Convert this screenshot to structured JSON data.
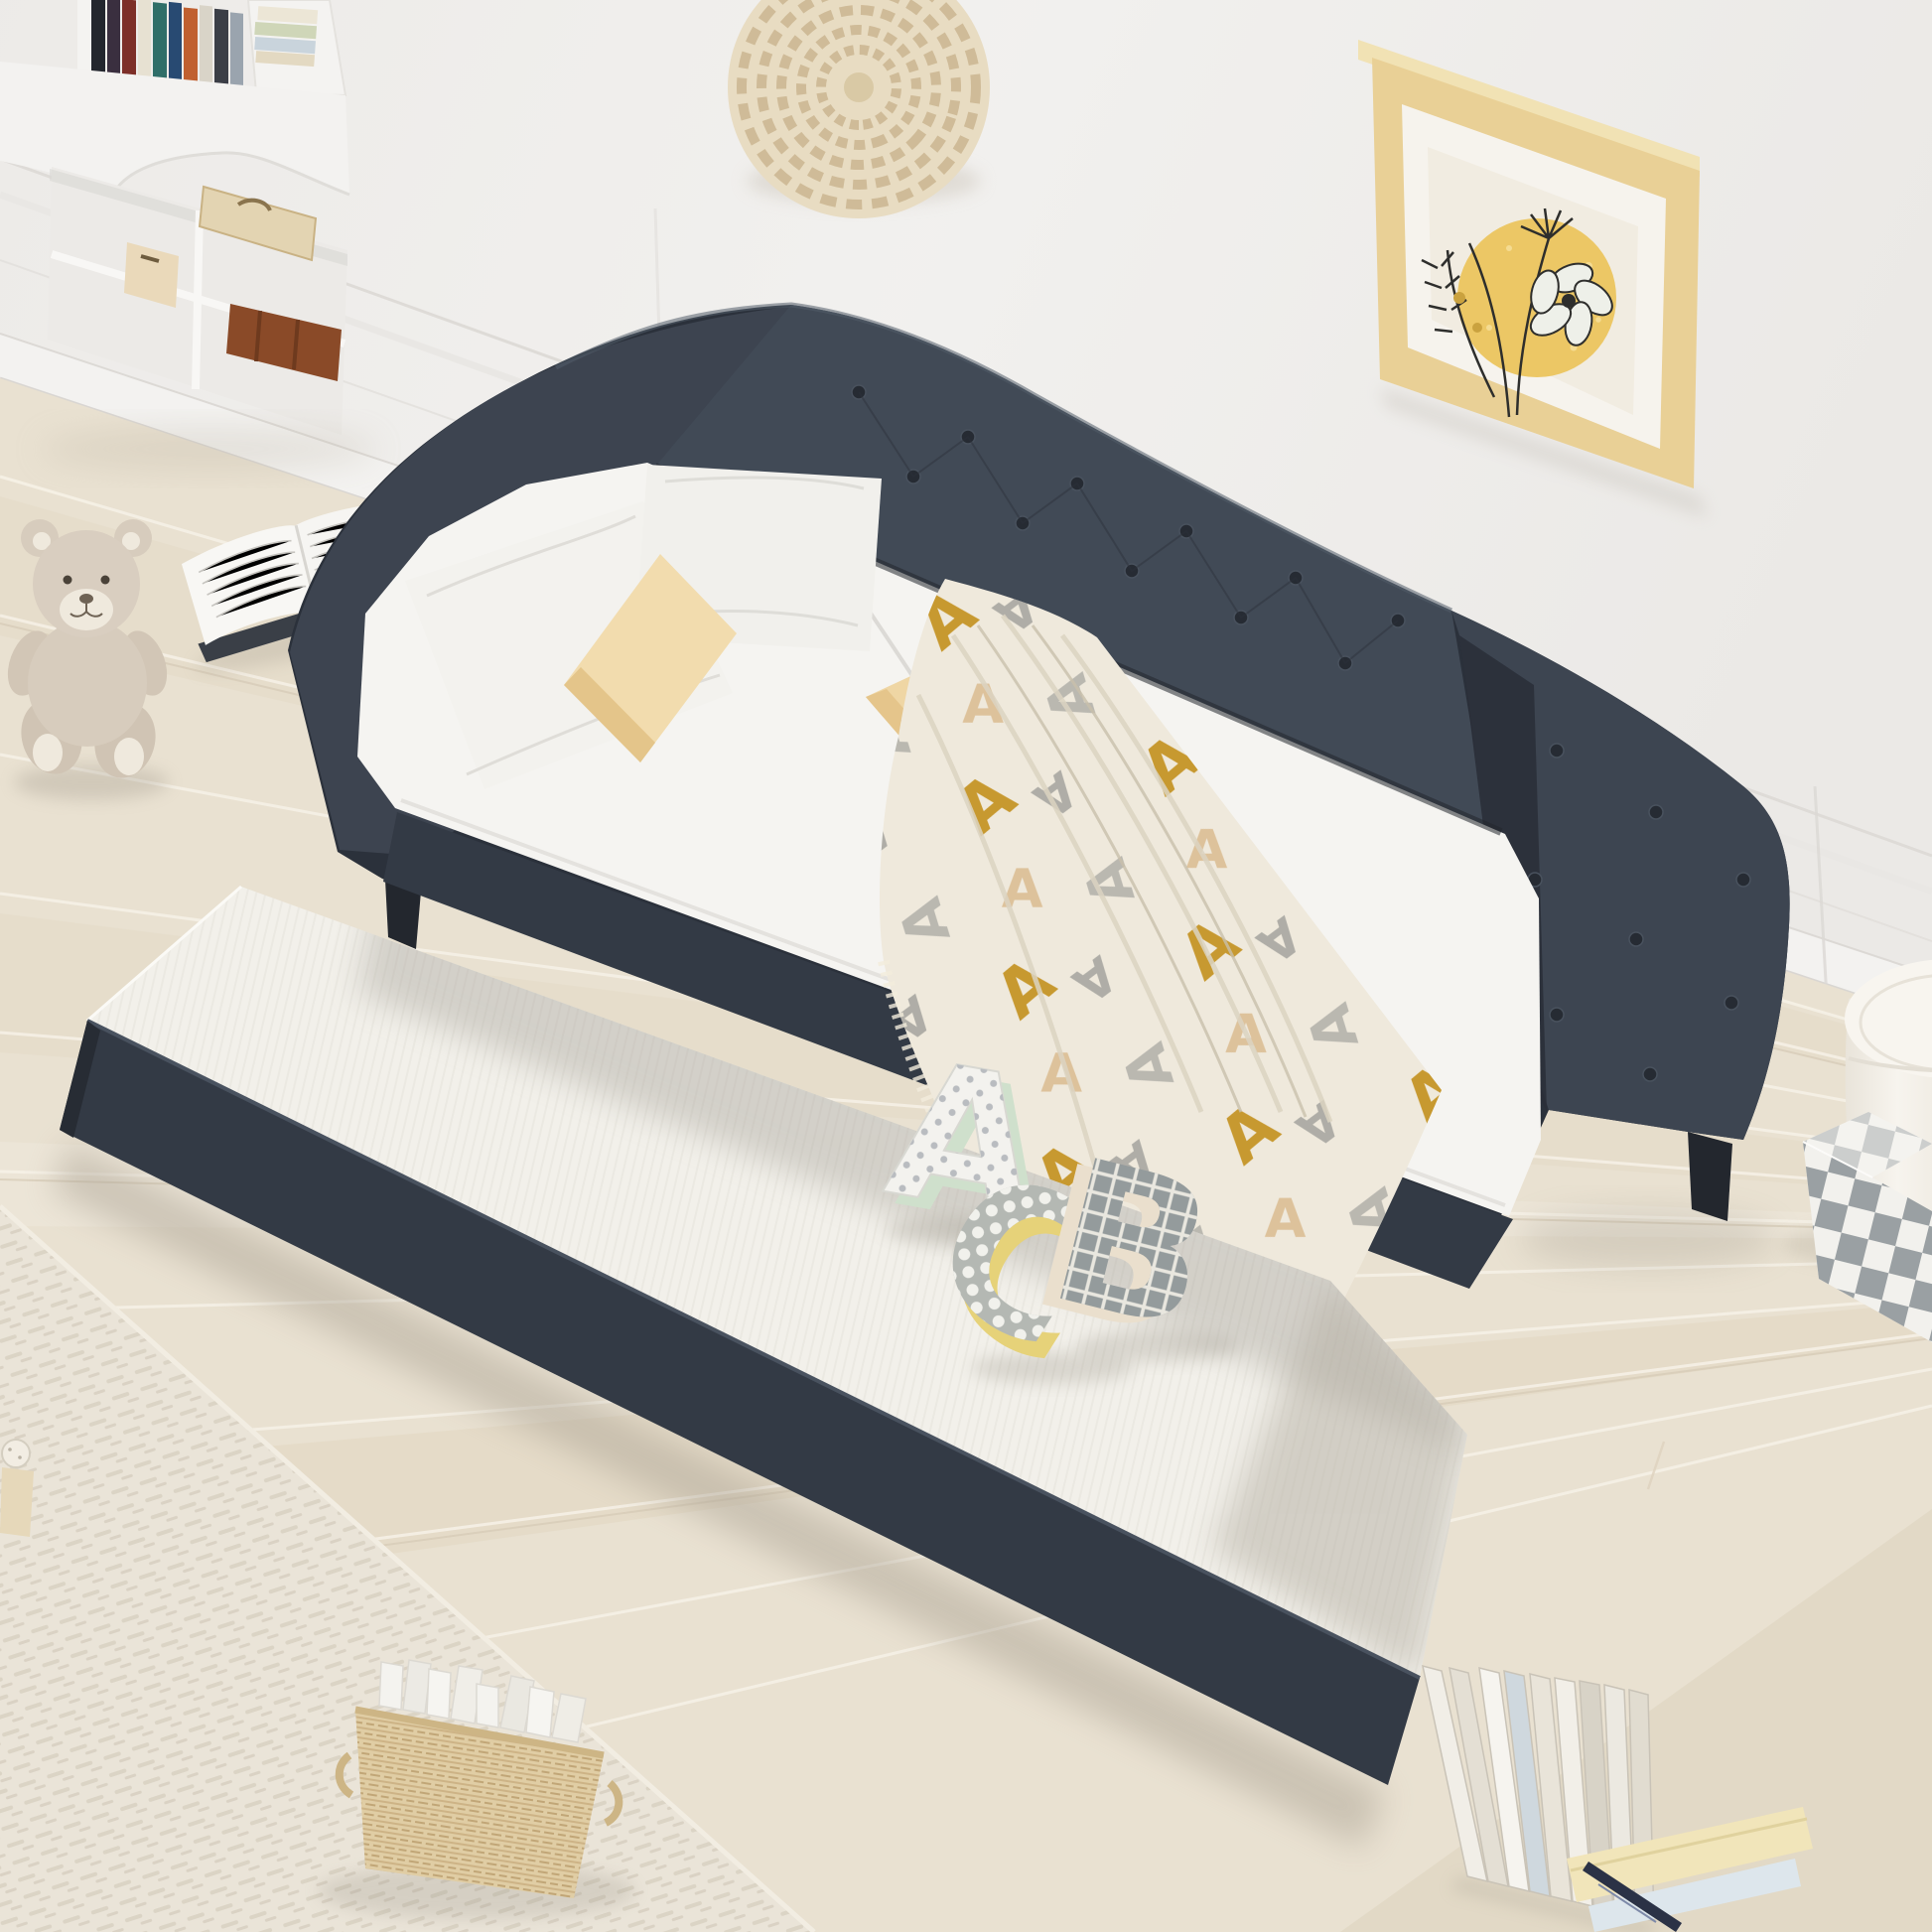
{
  "scene": {
    "description": "Bright bedroom product photo: dark charcoal button-tufted upholstered twin daybed with pulled-out trundle bed, white bedding, two cream accent pillows, patterned throw blanket, plush ABC letters, teddy bear, open book, wicker basket of books, framed botanical art and woven rattan wall decor on a white paneled wall over light wood flooring with a beige rug.",
    "objects": {
      "daybed": "charcoal gray tufted daybed frame",
      "trundle": "pull-out trundle with white mattress",
      "pillows": "two white pillows, two cream pillows",
      "blanket": "cream throw with gold and gray letter pattern",
      "letters": "plush toy letters A, C and B",
      "wall_art": "wood-framed botanical line art with yellow sun",
      "rattan": "round woven rope wall decor",
      "teddy_bear": "beige plush teddy bear on floor",
      "open_book": "open paperback lying on floor",
      "desk": "white corner desk with bookshelf and cubby storage",
      "basket": "wicker basket filled with white books",
      "floor_books": "row of standing books and flat stack with pen",
      "stool": "cream round storage stool",
      "checkered_box": "gray and white checkered box",
      "rug": "textured beige area rug",
      "knit_doll": "small knitted doll at left edge"
    }
  },
  "palette": {
    "wall": "#efedeb",
    "wall_band": "#f3f2f0",
    "floor": "#e9e1d1",
    "rug": "#eae4d8",
    "daybed": "#414a56",
    "daybed_dark": "#2b313b",
    "daybed_rail": "#333a45",
    "mattress": "#f5f4f1",
    "trundle_mattress": "#f2f0ea",
    "pillow_white": "#f3f2ee",
    "pillow_beige": "#f2dcae",
    "pillow_beige_dark": "#e2c184",
    "blanket": "#efe9dc",
    "blanket_gold": "#c3901d",
    "blanket_gray": "#9b9b97",
    "blanket_tan": "#d9b98c",
    "frame_wood": "#e9d096",
    "art_mat": "#f6f3ed",
    "art_bg": "#f1ece1",
    "art_sun": "#ecc765",
    "art_line": "#2e2e2c",
    "rattan": "#e8dcc2",
    "desk": "#f3f2f0",
    "leather_case": "#8a4a28",
    "cardboard": "#ead9ba",
    "basket": "#e0cda4",
    "bear": "#d7ccbd",
    "bear_light": "#efe9dd",
    "stool": "#f8f5ef",
    "checker_light": "#f2f1ed",
    "checker_gray": "#9aa0a3",
    "letterA_face": "#f3f2ee",
    "letterA_side": "#cfe0cc",
    "letterC_face": "#b4b8b3",
    "letterC_side": "#e6d279",
    "letterB_face": "#949b9c",
    "letterB_side": "#eadfcd",
    "book_white": "#f4f3ef",
    "pen": "#2b3246"
  }
}
